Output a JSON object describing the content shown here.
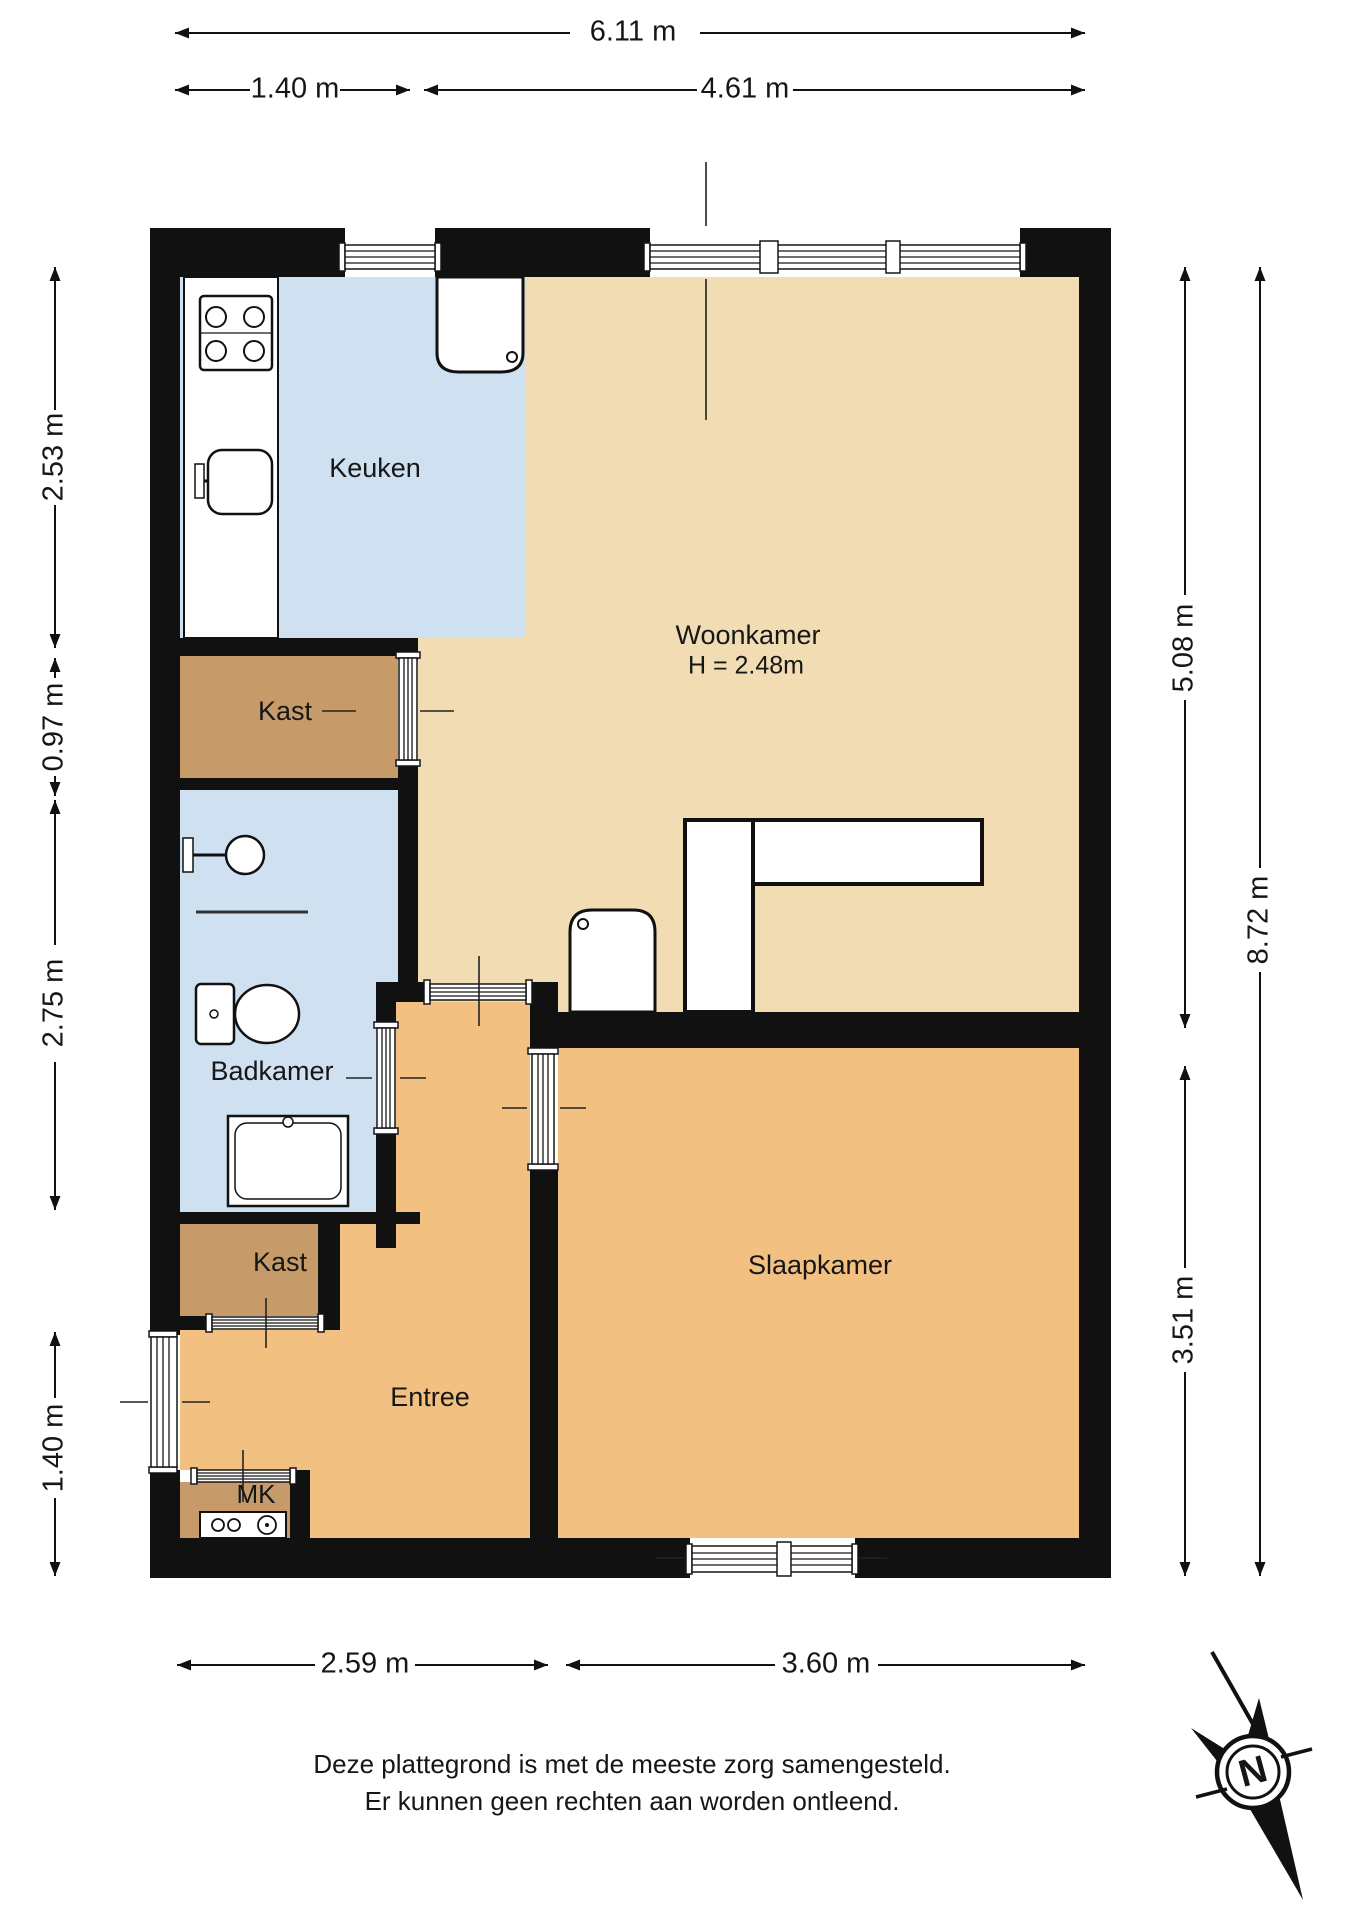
{
  "colors": {
    "wall": "#111111",
    "kitchen_floor": "#cfe1f1",
    "bathroom_floor": "#cfe1f1",
    "living_floor": "#f1dcb3",
    "bedroom_floor": "#f2c182",
    "entry_floor": "#f2c182",
    "closet_floor": "#c79b69"
  },
  "rooms": {
    "keuken": {
      "label": "Keuken"
    },
    "woonkamer": {
      "label": "Woonkamer",
      "height_note": "H = 2.48m"
    },
    "kast_boven": {
      "label": "Kast"
    },
    "badkamer": {
      "label": "Badkamer"
    },
    "kast_onder": {
      "label": "Kast"
    },
    "entree": {
      "label": "Entree"
    },
    "meterkast": {
      "label": "MK"
    },
    "slaapkamer": {
      "label": "Slaapkamer"
    }
  },
  "dimensions": {
    "top_total": "6.11 m",
    "top_left": "1.40 m",
    "top_right": "4.61 m",
    "left_keuken": "2.53 m",
    "left_kast": "0.97 m",
    "left_badkamer": "2.75 m",
    "left_entree": "1.40 m",
    "right_woonkamer": "5.08 m",
    "right_total": "8.72 m",
    "right_slaapkamer": "3.51 m",
    "bottom_left": "2.59 m",
    "bottom_right": "3.60 m"
  },
  "footer": {
    "line1": "Deze plattegrond is met de meeste zorg samengesteld.",
    "line2": "Er kunnen geen rechten aan worden ontleend."
  },
  "compass": {
    "label": "N"
  }
}
